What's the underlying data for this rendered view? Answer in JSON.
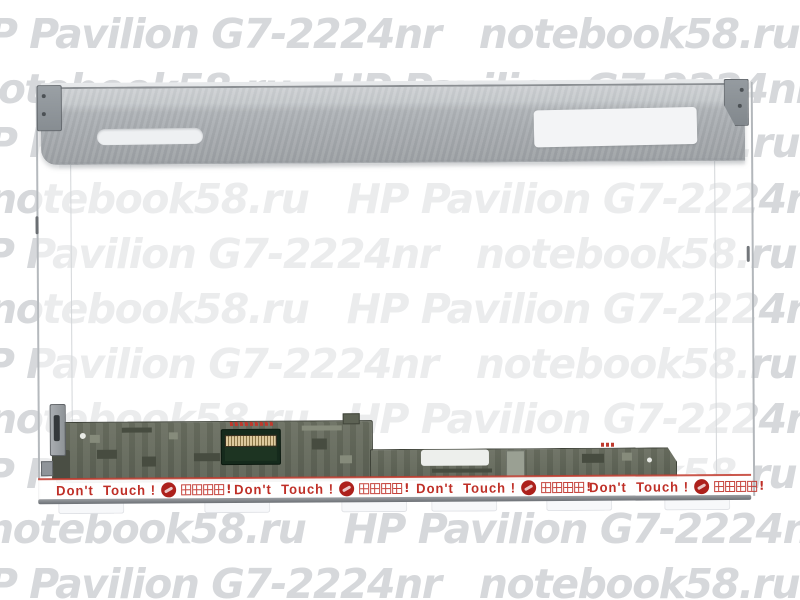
{
  "image": {
    "type": "product-photo",
    "subject": "Laptop LCD screen panel for HP Pavilion G7-2224nr"
  },
  "watermark": {
    "color": "#d6d8db",
    "store": "notebook58.ru",
    "model": "HP Pavilion G7-2224nr",
    "rows": [
      {
        "x": -45,
        "y": 13,
        "text": "HP Pavilion G7-2224nr   notebook58.ru   HP"
      },
      {
        "x": -30,
        "y": 68,
        "text": "notebook58.ru   HP Pavilion G7-2224nr"
      },
      {
        "x": -45,
        "y": 122,
        "text": "HP Pavilion G7-2224nr   notebook58.ru   HP"
      },
      {
        "x": -12,
        "y": 178,
        "text": "notebook58.ru   HP Pavilion G7-2224nr"
      },
      {
        "x": -48,
        "y": 233,
        "text": "HP Pavilion G7-2224nr   notebook58.ru   HP"
      },
      {
        "x": -12,
        "y": 288,
        "text": "notebook58.ru   HP Pavilion G7-2224nr"
      },
      {
        "x": -48,
        "y": 343,
        "text": "HP Pavilion G7-2224nr   notebook58.ru   HP"
      },
      {
        "x": -12,
        "y": 398,
        "text": "notebook58.ru   HP Pavilion G7-2224nr"
      },
      {
        "x": -48,
        "y": 453,
        "text": "HP Pavilion G7-2224nr   notebook58.ru   HP"
      },
      {
        "x": -15,
        "y": 508,
        "text": "notebook58.ru   HP Pavilion G7-2224nr"
      },
      {
        "x": -45,
        "y": 563,
        "text": "HP Pavilion G7-2224nr   notebook58.ru   HP"
      }
    ]
  },
  "warning": {
    "en": "Don't  Touch !",
    "zh": "請勿碰觸!",
    "color": "#bf2f27",
    "positions_x": [
      55,
      233,
      415,
      588
    ]
  },
  "panel": {
    "sticker_tabs_x": [
      57,
      203,
      340,
      430,
      545,
      663
    ]
  }
}
